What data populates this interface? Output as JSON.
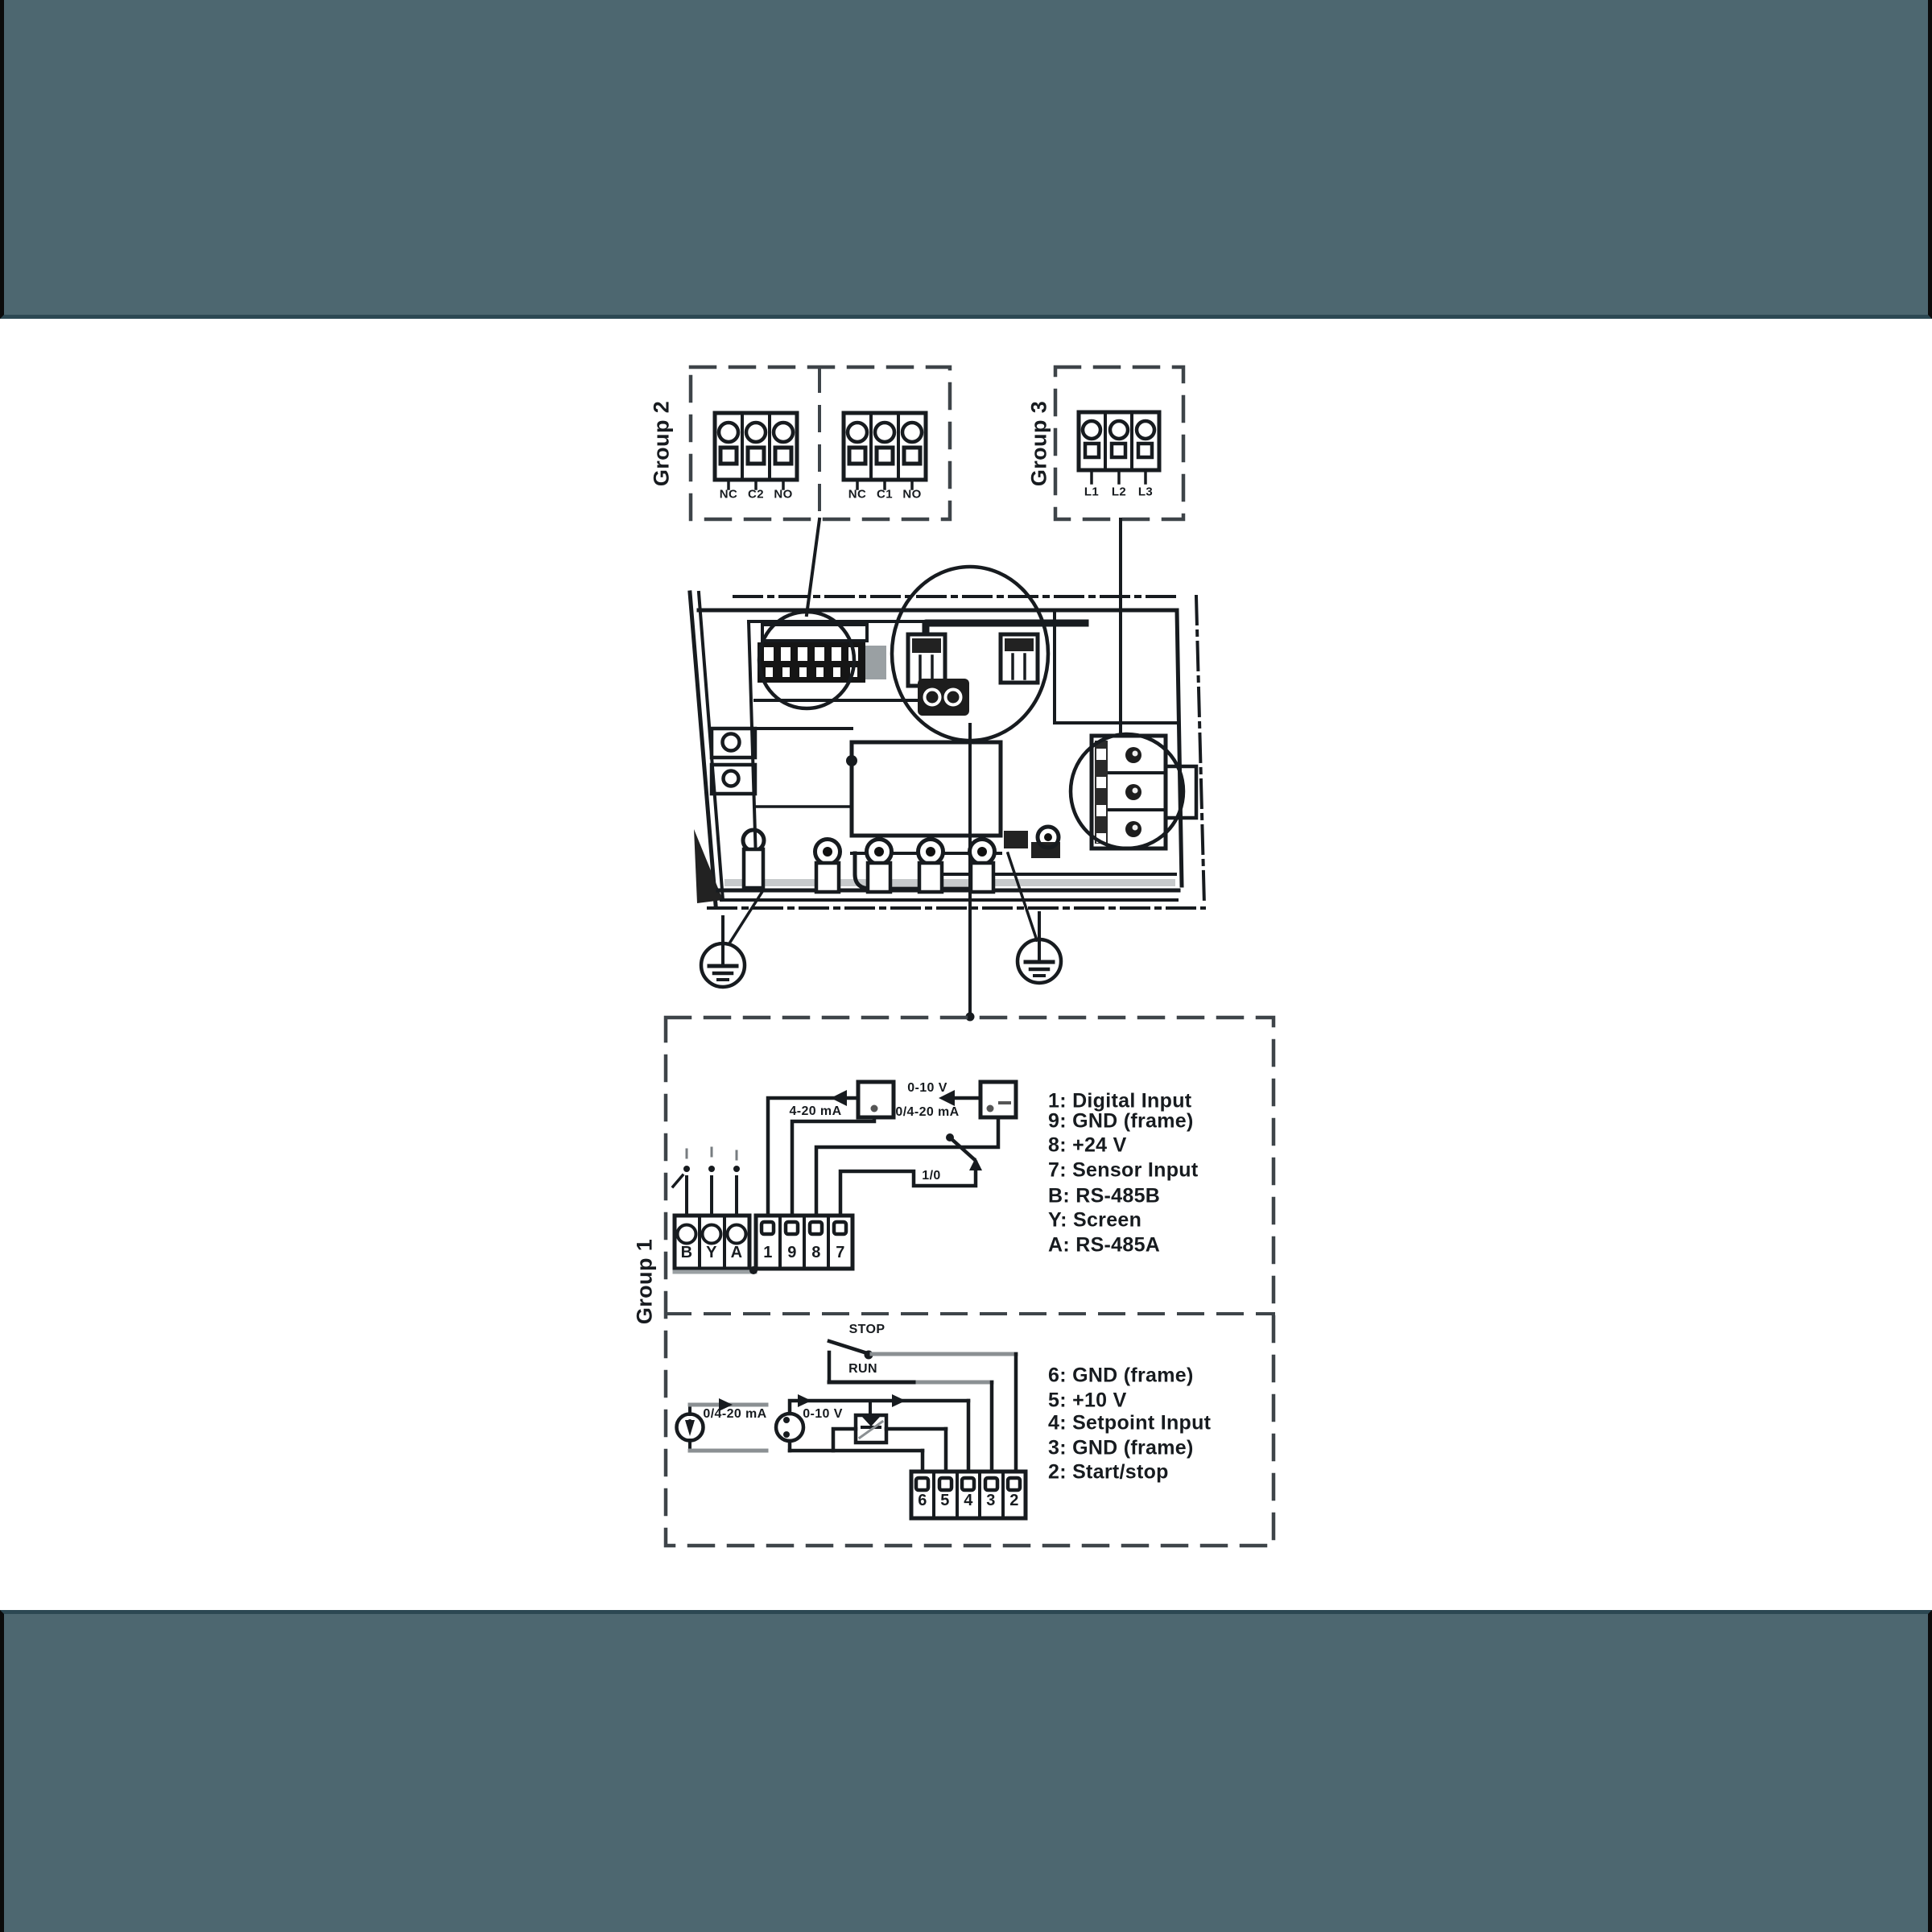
{
  "colors": {
    "band": "#4d6770",
    "band_divider": "#2c4853",
    "ink": "#171b1f"
  },
  "group2": {
    "label": "Group 2",
    "relay_blocks": [
      [
        "NC",
        "C2",
        "NO"
      ],
      [
        "NC",
        "C1",
        "NO"
      ]
    ]
  },
  "group3": {
    "label": "Group 3",
    "power_terminals": [
      "L1",
      "L2",
      "L3"
    ]
  },
  "group1": {
    "label": "Group 1",
    "upper": {
      "comm_terminals": [
        "B",
        "Y",
        "A"
      ],
      "io_terminals": [
        "1",
        "9",
        "8",
        "7"
      ],
      "wire_labels": {
        "signal_top": "0-10 V",
        "signal_bottom": "0/4-20 mA",
        "sensor": "4-20 mA",
        "switch": "1/0"
      },
      "legend": [
        "1: Digital Input",
        "9: GND (frame)",
        "8: +24 V",
        "7: Sensor Input",
        "B: RS-485B",
        "Y: Screen",
        "A: RS-485A"
      ]
    },
    "lower": {
      "terminals": [
        "6",
        "5",
        "4",
        "3",
        "2"
      ],
      "wire_labels": {
        "stop": "STOP",
        "run": "RUN",
        "sensor": "0/4-20 mA",
        "pot": "0-10 V"
      },
      "legend": [
        "6: GND (frame)",
        "5: +10 V",
        "4: Setpoint Input",
        "3: GND (frame)",
        "2: Start/stop"
      ]
    }
  }
}
